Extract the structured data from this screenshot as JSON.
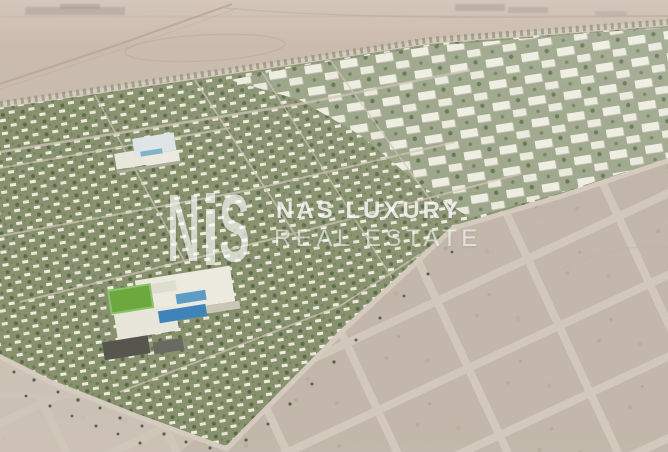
{
  "watermark": {
    "logo_left": "N",
    "logo_right": "S",
    "brand_line1": "NAS LUXURY",
    "brand_line2": "REAL ESTATE"
  },
  "scene": {
    "type": "aerial-masterplan-render",
    "palette": {
      "desert": "#c7bcae",
      "desert_light": "#d5c6bb",
      "desert_plots": "#c1b6a9",
      "plot_road": "#d2c9bc",
      "greenery": "#87916d",
      "greenery_dark": "#5a684a",
      "buildings_white": "#edecdf",
      "apartment_shadow": "#b9b7a8",
      "pool_blue": "#3e84b8",
      "sports_field_green": "#6da83e",
      "dark_roof": "#56554e",
      "watermark_white": "#ffffff"
    }
  }
}
